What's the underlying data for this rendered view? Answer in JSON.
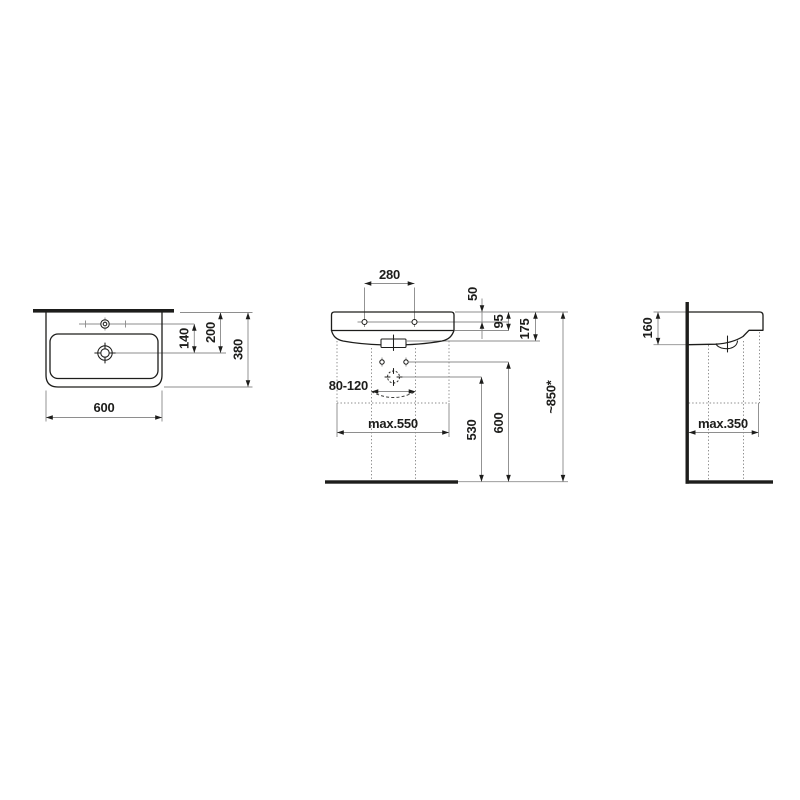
{
  "drawing": {
    "type": "washbasin-with-pedestal-dimension-drawing",
    "units": "mm",
    "views": {
      "top": {
        "name": "top-view",
        "dims": {
          "width": "600",
          "depth": "380",
          "tap_to_drain": "140",
          "edge_to_drain": "200"
        }
      },
      "front": {
        "name": "front-view",
        "dims": {
          "fixing_hole_spacing": "280",
          "rim_to_fixing_hole": "50",
          "rim_to_underside": "95",
          "apron_height": "175",
          "outlet_offset_range": "80-120",
          "clearance_width": "max.550",
          "outlet_height": "530",
          "fixing_height": "600",
          "installation_height": "~850*"
        }
      },
      "side": {
        "name": "side-view",
        "dims": {
          "rim_section_height": "160",
          "clearance_depth": "max.350"
        }
      }
    }
  }
}
